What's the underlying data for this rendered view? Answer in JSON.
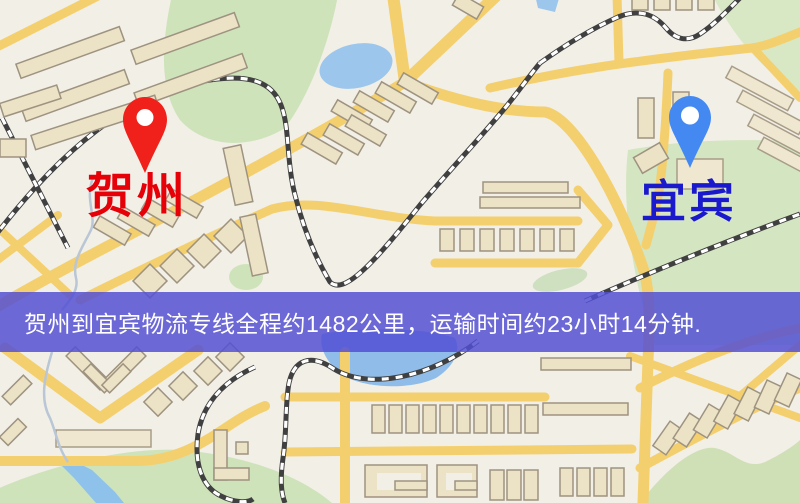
{
  "map": {
    "markers": {
      "origin": {
        "label": "贺州",
        "pin_color": "#f0211a",
        "label_color": "#e60008"
      },
      "destination": {
        "label": "宜宾",
        "pin_color": "#4489f2",
        "label_color": "#1a1acc"
      }
    },
    "banner": {
      "text": "贺州到宜宾物流专线全程约1482公里，运输时间约23小时14分钟."
    },
    "colors": {
      "background": "#f2efe7",
      "road": "#f4cf6e",
      "water": "#9cc6ec",
      "park": "#cfe3bb",
      "railway": "#404040",
      "building": "#ece2c6",
      "banner_bg": "rgba(82,79,212,0.84)",
      "banner_text": "#ffffff"
    }
  }
}
